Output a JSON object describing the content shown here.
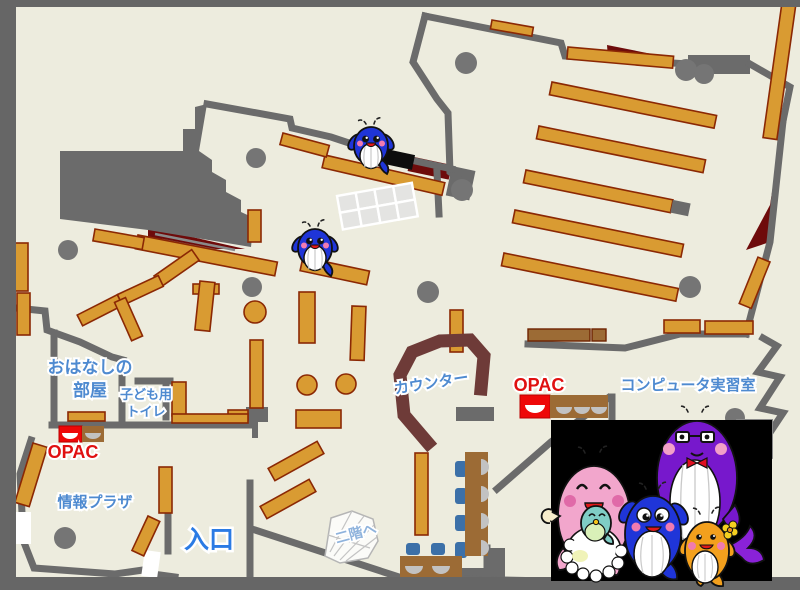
{
  "page": {
    "kind": "library-floor-map",
    "floor_color": "#edecde",
    "frame_color": "#666666",
    "wall_color": "#6b6b6b",
    "shelf_color": "#d99b32",
    "shelf_edge_color": "#8b2804",
    "accent_dark_red": "#6e0b0b",
    "counter_color": "#6e3b38",
    "desk_brown": "#9c6b35",
    "chair_blue": "#3c70a8",
    "opac_desk_red": "#ee0808",
    "label_blue": "#4e8ad0",
    "entrance_blue": "#2b7be4",
    "opac_text_red": "#e01010",
    "mascot_panel_color": "#000000"
  },
  "labels": {
    "storytelling_room_line1": "おはなしの",
    "storytelling_room_line2": "部屋",
    "kids_toilet_line1": "子ども用",
    "kids_toilet_line2": "トイレ",
    "opac_left": "OPAC",
    "opac_right": "OPAC",
    "info_plaza": "情報プラザ",
    "entrance": "入口",
    "counter": "カウンター",
    "computer_room": "コンピュータ実習室",
    "to_second_floor": "二階へ"
  },
  "mascots": {
    "on_map": [
      {
        "icon": "blue-whale-mascot-icon",
        "body_color": "#1f35d8"
      },
      {
        "icon": "blue-whale-mascot-icon",
        "body_color": "#1f35d8"
      }
    ],
    "family_panel": [
      {
        "icon": "pink-mother-whale-icon",
        "body_color": "#f2a6cc"
      },
      {
        "icon": "teal-baby-whale-icon",
        "body_color": "#7fcdc5"
      },
      {
        "icon": "purple-father-whale-icon",
        "body_color": "#7718cc"
      },
      {
        "icon": "blue-child-whale-icon",
        "body_color": "#1f35d8"
      },
      {
        "icon": "orange-child-whale-icon",
        "body_color": "#f3a01d"
      }
    ]
  }
}
